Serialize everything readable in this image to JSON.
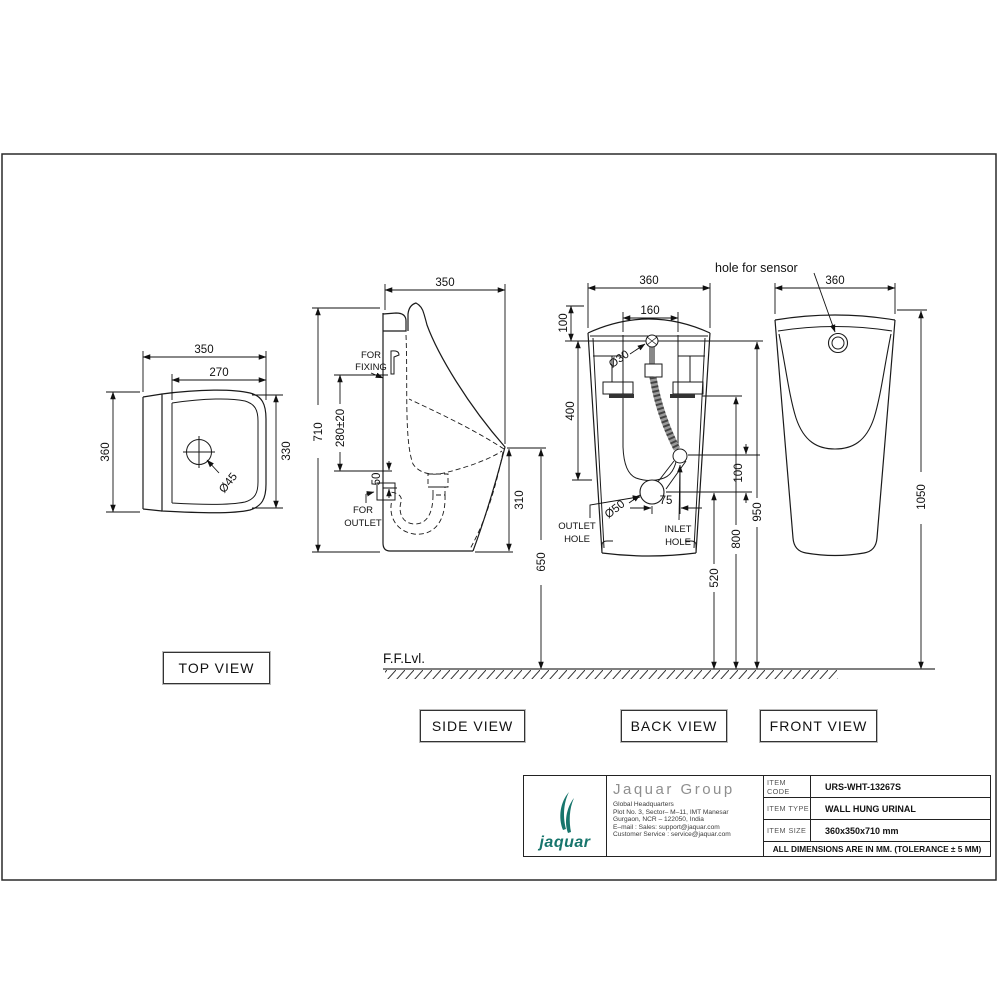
{
  "views": {
    "top": {
      "label": "TOP VIEW",
      "dims": {
        "width": "350",
        "inner_width": "270",
        "depth": "360",
        "inner_depth": "330",
        "drain_hole": "Ø45"
      }
    },
    "side": {
      "label": "SIDE VIEW",
      "dims": {
        "width": "350",
        "height": "710",
        "fixing_drop": "280±20",
        "outlet_drop": "50",
        "rim_depth": "310",
        "rim_height": "650"
      },
      "notes": {
        "fixing_l1": "FOR",
        "fixing_l2": "FIXING",
        "outlet_l1": "FOR",
        "outlet_l2": "OUTLET"
      }
    },
    "back": {
      "label": "BACK VIEW",
      "dims": {
        "width": "360",
        "fixing_span": "160",
        "crown_offset": "100",
        "bracket_drop": "400",
        "inlet_offset": "100",
        "outlet_height": "520",
        "bracket_height": "800",
        "sensor_height": "950",
        "sensor_hole": "Ø30",
        "outlet_hole": "Ø50",
        "hole_spacing": "75"
      },
      "notes": {
        "outlet_l1": "OUTLET",
        "outlet_l2": "HOLE",
        "inlet_l1": "INLET",
        "inlet_l2": "HOLE"
      }
    },
    "front": {
      "label": "FRONT VIEW",
      "dims": {
        "width": "360",
        "total_height": "1050"
      },
      "notes": {
        "sensor": "hole for sensor"
      }
    }
  },
  "floor": {
    "label": "F.F.Lvl."
  },
  "title_block": {
    "brand": {
      "logo_text": "jaquar",
      "logo_color": "#17756c",
      "company": "Jaquar Group"
    },
    "address": [
      "Global Headquarters",
      "Plot No. 3, Sector– M–11, IMT Manesar",
      "Gurgaon, NCR – 122050, India",
      "E–mail : Sales: support@jaquar.com",
      "Customer Service : service@jaquar.com"
    ],
    "rows": [
      {
        "label": "ITEM CODE",
        "value": "URS-WHT-13267S"
      },
      {
        "label": "ITEM TYPE",
        "value": "WALL HUNG URINAL"
      },
      {
        "label": "ITEM SIZE",
        "value": "360x350x710 mm"
      }
    ],
    "tolerance": "ALL DIMENSIONS ARE IN MM. (TOLERANCE ± 5 MM)"
  }
}
